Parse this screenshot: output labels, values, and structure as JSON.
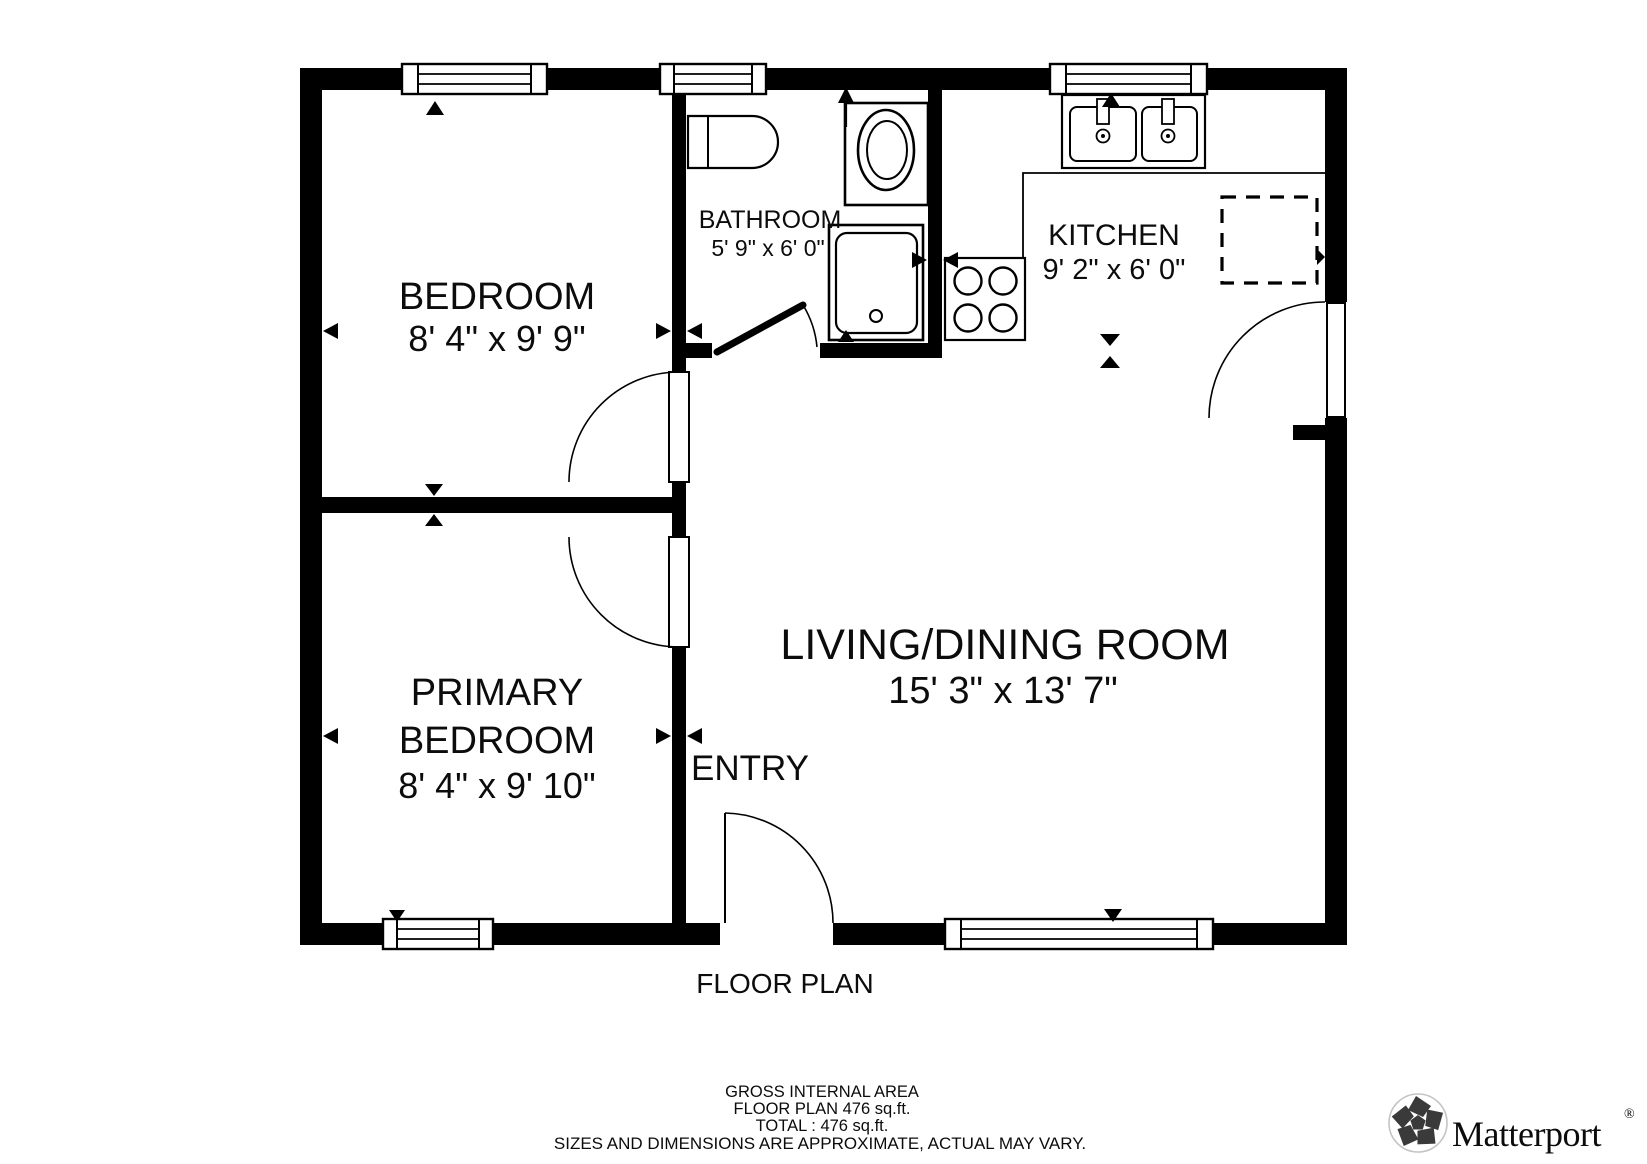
{
  "floor_plan": {
    "title": "FLOOR PLAN",
    "rooms": {
      "bedroom": {
        "name": "BEDROOM",
        "dimensions": "8' 4\" x 9' 9\""
      },
      "bathroom": {
        "name": "BATHROOM",
        "dimensions": "5' 9\" x 6' 0\""
      },
      "kitchen": {
        "name": "KITCHEN",
        "dimensions": "9' 2\" x 6' 0\""
      },
      "living_dining": {
        "name": "LIVING/DINING ROOM",
        "dimensions": "15' 3\" x 13' 7\""
      },
      "primary_bedroom": {
        "name_line1": "PRIMARY",
        "name_line2": "BEDROOM",
        "dimensions": "8' 4\" x 9' 10\""
      },
      "entry": {
        "name": "ENTRY"
      }
    },
    "area_summary": {
      "gross_internal_area_label": "GROSS INTERNAL AREA",
      "floor_plan_area": "FLOOR PLAN 476 sq.ft.",
      "total_area": "TOTAL :  476 sq.ft.",
      "disclaimer": "SIZES AND DIMENSIONS ARE APPROXIMATE, ACTUAL MAY VARY."
    },
    "branding": {
      "logo_text": "Matterport",
      "registered_mark": "®"
    },
    "colors": {
      "wall": "#000000",
      "background": "#ffffff",
      "disclaimer_text": "#6d6d6d",
      "logo_text": "#2e2e2e"
    }
  }
}
